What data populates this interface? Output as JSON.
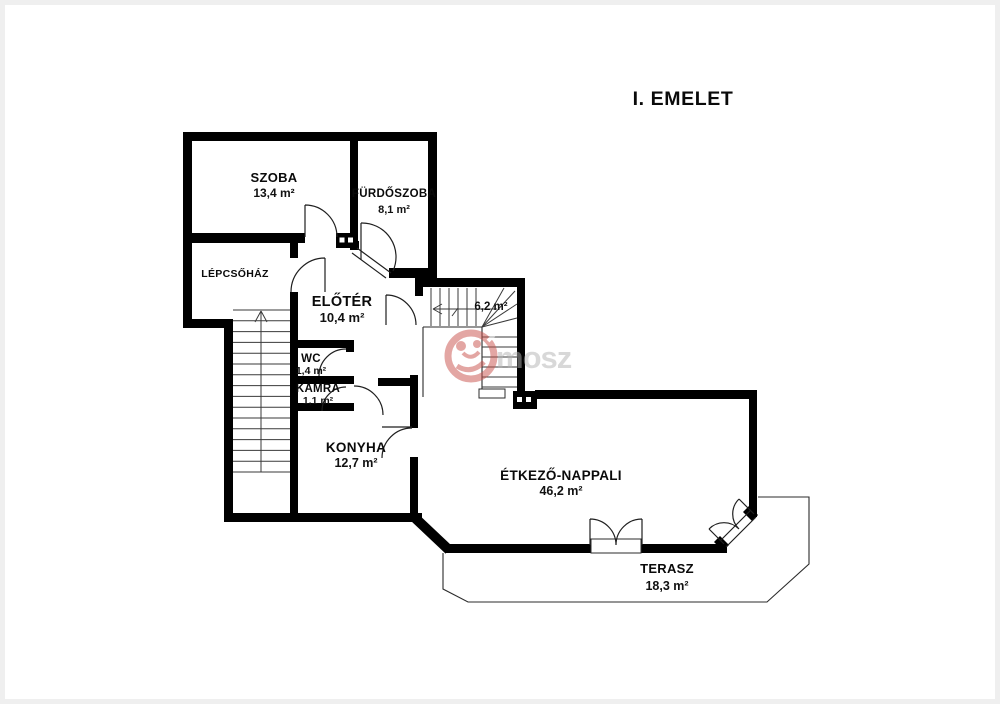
{
  "page": {
    "title": "I. EMELET",
    "background": "#ffffff",
    "wall_color": "#000000"
  },
  "watermark": {
    "text": "mosz",
    "logo_color": "#c9504a",
    "text_color": "#b3b3b3"
  },
  "rooms": [
    {
      "id": "szoba",
      "name": "SZOBA",
      "area": "13,4 m²",
      "x": 269,
      "name_y": 177,
      "area_y": 192,
      "name_size": 13,
      "area_size": 12
    },
    {
      "id": "furdoszoba",
      "name": "FÜRDŐSZOBA",
      "area": "8,1 m²",
      "x": 389,
      "name_y": 192,
      "area_y": 208,
      "name_size": 11.5,
      "area_size": 11
    },
    {
      "id": "lepcsohaz",
      "name": "LÉPCSŐHÁZ",
      "area": "",
      "x": 230,
      "name_y": 272,
      "area_y": 0,
      "name_size": 10.5,
      "area_size": 0
    },
    {
      "id": "eloter",
      "name": "ELŐTÉR",
      "area": "10,4 m²",
      "x": 337,
      "name_y": 301,
      "area_y": 317,
      "name_size": 14.5,
      "area_size": 13
    },
    {
      "id": "wc",
      "name": "WC",
      "area": "1,4 m²",
      "x": 306,
      "name_y": 357,
      "area_y": 369,
      "name_size": 11.5,
      "area_size": 10.5
    },
    {
      "id": "kamra",
      "name": "KAMRA",
      "area": "1,1 m²",
      "x": 313,
      "name_y": 387,
      "area_y": 399,
      "name_size": 11.5,
      "area_size": 10.5
    },
    {
      "id": "konyha",
      "name": "KONYHA",
      "area": "12,7 m²",
      "x": 351,
      "name_y": 447,
      "area_y": 462,
      "name_size": 13.5,
      "area_size": 12.5
    },
    {
      "id": "stairwell",
      "name": "",
      "area": "6,2 m²",
      "x": 486,
      "name_y": 0,
      "area_y": 305,
      "name_size": 0,
      "area_size": 11.5
    },
    {
      "id": "nappali",
      "name": "ÉTKEZŐ-NAPPALI",
      "area": "46,2 m²",
      "x": 556,
      "name_y": 475,
      "area_y": 490,
      "name_size": 13.5,
      "area_size": 12.5
    },
    {
      "id": "terasz",
      "name": "TERASZ",
      "area": "18,3 m²",
      "x": 662,
      "name_y": 568,
      "area_y": 585,
      "name_size": 13,
      "area_size": 12.5
    }
  ]
}
